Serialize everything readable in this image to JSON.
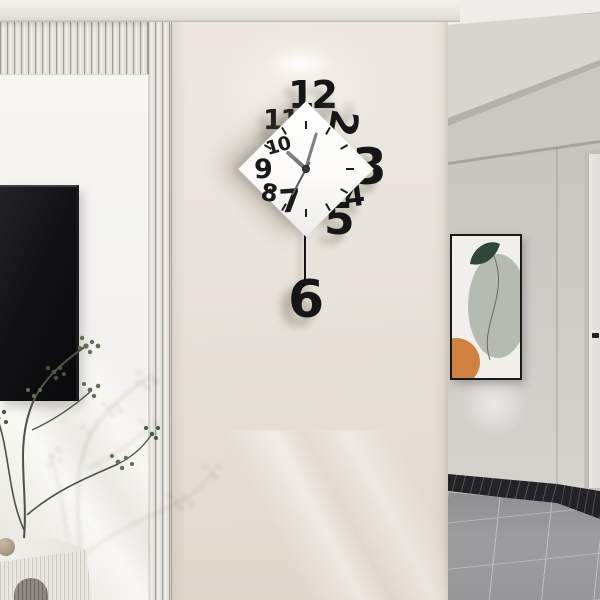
{
  "meta": {
    "type": "product-lifestyle-photo",
    "subject": "Geometric diamond pendulum wall clock mounted on a beige pillar between a slatted TV wall and a grey hallway",
    "canvas": {
      "width": 600,
      "height": 600
    }
  },
  "clock": {
    "numerals": {
      "n2": "2",
      "n3": "3",
      "n4": "4",
      "n5": "5",
      "n6": "6",
      "n7": "7",
      "n8": "8",
      "n9": "9",
      "n10": "10",
      "n11": "11",
      "n12": "12"
    },
    "time_shown_approx": "10:03",
    "style": {
      "face_shape": "rotated-square-diamond",
      "face_color": "#ffffff",
      "numeral_color": "#161616",
      "hand_color": "#84848a",
      "pendulum": "rod with numeral 6"
    }
  },
  "scene": {
    "left_side": [
      "vertical slat panel wall",
      "wall-mounted black tv",
      "green branch plant with wall shadow",
      "white fluted sideboard",
      "ceramic ball vase"
    ],
    "right_side": [
      "recessed hallway ceiling",
      "abstract framed artwork",
      "white interior door with dark handle",
      "dark marble baseboard",
      "grey tile floor"
    ]
  },
  "palette": {
    "pillar_wall": "#e9e4dc",
    "left_wall": "#f4f2ee",
    "hall_wall": "#cbc8c4",
    "ceiling": "#d8d5d1",
    "floor_tile": "#98979b",
    "baseboard": "#232327",
    "tv_screen": "#141416",
    "leaf_green": "#5e7150",
    "art_orange": "#d08142",
    "art_dark_green": "#30483a",
    "art_sage": "#b5bbb1",
    "cabinet": "#e9e6e0"
  }
}
